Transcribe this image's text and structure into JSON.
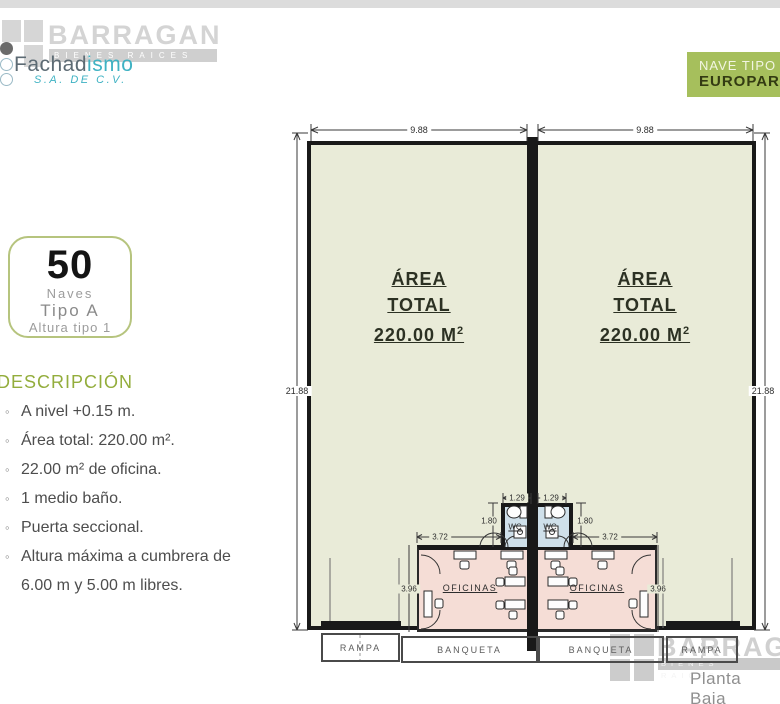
{
  "brand": {
    "name": "BARRAGAN",
    "tagline": "BIENES RAICES"
  },
  "company": {
    "name_a": "Fachad",
    "name_b": "ismo",
    "subtitle": "S.A. DE C.V."
  },
  "nave_tag": {
    "line1": "NAVE TIPO",
    "line2": "EUROPARK"
  },
  "badge": {
    "number": "50",
    "caption1": "Naves",
    "caption2": "Tipo A",
    "caption3": "Altura tipo 1"
  },
  "description": {
    "title": "DESCRIPCIÓN",
    "items": [
      "A nivel +0.15 m.",
      "Área total: 220.00 m².",
      "22.00 m² de oficina.",
      "1 medio baño.",
      "Puerta seccional.",
      "Altura máxima a cumbrera de 6.00 m y 5.00 m libres."
    ]
  },
  "plan": {
    "area_block": {
      "line1": "ÁREA",
      "line2": "TOTAL",
      "value": "220.00 M",
      "sup": "2"
    },
    "dims": {
      "unit_width": "9.88",
      "unit_depth": "21.88",
      "wc_width": "1.29",
      "wc_depth": "1.80",
      "office_width": "3.72",
      "office_depth": "3.96"
    },
    "labels": {
      "wc": "WC",
      "office": "OFICINAS",
      "rampa": "RAMPA",
      "banqueta": "BANQUETA"
    }
  },
  "footer": {
    "brand": "BARRAGAN",
    "brand_tagline": "BIENES RAICES",
    "caption": "Planta Baja"
  },
  "colors": {
    "accent_green": "#a6bf5c",
    "heading_green": "#93ad3c",
    "warehouse_fill": "#e9ebd8",
    "office_fill": "#f5ddd6",
    "wc_fill": "#cfe0ea",
    "wall": "#191919",
    "watermark_gray": "#cdcdcd",
    "company_teal": "#3fb2c3"
  }
}
